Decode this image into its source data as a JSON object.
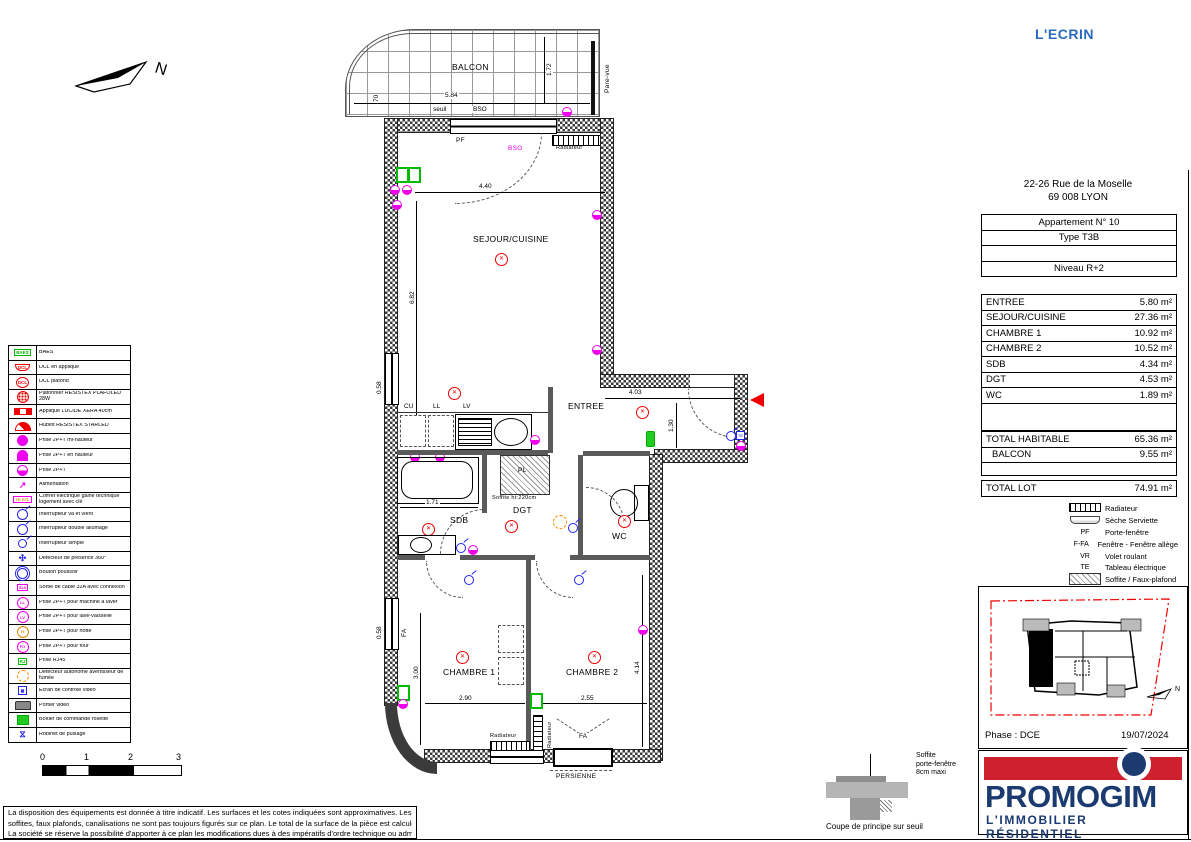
{
  "project": {
    "name": "L'ECRIN",
    "address_line1": "22-26 Rue de la Moselle",
    "address_line2": "69 008  LYON",
    "phase": "Phase : DCE",
    "date": "19/07/2024"
  },
  "apartment": {
    "rows": [
      "Appartement N° 10",
      "Type T3B",
      "",
      "Niveau R+2"
    ]
  },
  "areas": [
    {
      "label": "ENTREE",
      "value": "5.80 m²"
    },
    {
      "label": "SEJOUR/CUISINE",
      "value": "27.36 m²"
    },
    {
      "label": "CHAMBRE 1",
      "value": "10.92 m²"
    },
    {
      "label": "CHAMBRE 2",
      "value": "10.52 m²"
    },
    {
      "label": "SDB",
      "value": "4.34 m²"
    },
    {
      "label": "DGT",
      "value": "4.53 m²"
    },
    {
      "label": "WC",
      "value": "1.89 m²"
    }
  ],
  "totals": [
    {
      "label": "TOTAL HABITABLE",
      "value": "65.36 m²"
    },
    {
      "label": "BALCON",
      "value": "9.55 m²"
    }
  ],
  "total_lot": {
    "label": "TOTAL LOT",
    "value": "74.91 m²"
  },
  "rightLegend": [
    {
      "abbr": "",
      "label": "Radiateur"
    },
    {
      "abbr": "",
      "label": "Sèche Serviette"
    },
    {
      "abbr": "PF",
      "label": "Porte-fenêtre"
    },
    {
      "abbr": "F-FA",
      "label": "Fenêtre - Fenêtre allège"
    },
    {
      "abbr": "VR",
      "label": "Volet roulant"
    },
    {
      "abbr": "TE",
      "label": "Tableau électrique"
    },
    {
      "abbr": "",
      "label": "Soffite / Faux-plafond"
    }
  ],
  "leftLegend": [
    {
      "sym": "BAES",
      "label": "BAES"
    },
    {
      "sym": "DCL",
      "label": "DCL en applique"
    },
    {
      "sym": "DCL",
      "label": "DCL plafond"
    },
    {
      "sym": "",
      "label": "Plafonnier RESISTEX PLAFOLED 28W"
    },
    {
      "sym": "",
      "label": "Applique LUCIDE XERA 40cm"
    },
    {
      "sym": "",
      "label": "Hublot RESISTEX STARLED"
    },
    {
      "sym": "",
      "label": "Prise 2P+T mi-hauteur"
    },
    {
      "sym": "",
      "label": "Prise 2P+T en hauteur"
    },
    {
      "sym": "",
      "label": "Prise 2P+T"
    },
    {
      "sym": "↗",
      "label": "Alimentation"
    },
    {
      "sym": "TE GTL",
      "label": "Coffret électrique gaine technique logement avec clé"
    },
    {
      "sym": "",
      "label": "Interrupteur va et vient"
    },
    {
      "sym": "",
      "label": "Interrupteur double allumage"
    },
    {
      "sym": "",
      "label": "Interrupteur simple"
    },
    {
      "sym": "✣",
      "label": "Détecteur de présence 360°"
    },
    {
      "sym": "",
      "label": "Bouton poussoir"
    },
    {
      "sym": "32A",
      "label": "Sortie de câble 32A avec connexion"
    },
    {
      "sym": "LL",
      "label": "Prise 2P+T pour machine à laver"
    },
    {
      "sym": "LV",
      "label": "Prise 2P+T pour lave-vaisselle"
    },
    {
      "sym": "H",
      "label": "Prise 2P+T pour hotte"
    },
    {
      "sym": "FO",
      "label": "Prise 2P+T pour four"
    },
    {
      "sym": "RJ",
      "label": "Prise RJ45"
    },
    {
      "sym": "",
      "label": "Détecteur autonome avertisseur de fumée"
    },
    {
      "sym": "",
      "label": "Écran de contrôle vidéo"
    },
    {
      "sym": "",
      "label": "Portier vidéo"
    },
    {
      "sym": "",
      "label": "Boîtier de commande rosette"
    },
    {
      "sym": "⧖",
      "label": "Robinet de puisage"
    }
  ],
  "plan": {
    "balcon": "BALCON",
    "sejour": "SEJOUR/CUISINE",
    "entree": "ENTREE",
    "sdb": "SDB",
    "dgt": "DGT",
    "wc": "WC",
    "chambre1": "CHAMBRE 1",
    "chambre2": "CHAMBRE 2",
    "persienne": "PERSIENNE",
    "pf": "PF",
    "fa": "FA",
    "bso": "BSO",
    "seuil": "seuil",
    "pare_vue": "Pare-vue",
    "radiateur": "Radiateur",
    "cu": "CU",
    "ll": "LL",
    "lv": "LV",
    "pl": "PL",
    "soffite_note": "Soffite ht:220cm",
    "north": "N",
    "dims": {
      "balcon_l": "5.84",
      "balcon_d": "1.72",
      "d70": "70",
      "sejour_w": "4.40",
      "sejour_h": "6.82",
      "entree_w": "4.03",
      "entree_h": "1.30",
      "sdb_w": "1.71",
      "ch1_h": "3.00",
      "ch1_w": "2.90",
      "ch2_w": "2.55",
      "ch2_h": "4.14",
      "win": "0.58"
    }
  },
  "scalebar": {
    "t0": "0",
    "t1": "1",
    "t2": "2",
    "t3": "3"
  },
  "coupe": {
    "note1": "Soffite",
    "note2": "porte-fenêtre",
    "note3": "8cm maxi",
    "caption": "Coupe de principe sur seuil"
  },
  "logo": {
    "name": "PROMOGIM",
    "tagline": "L'IMMOBILIER  RÉSIDENTIEL",
    "red": "#cf2030",
    "navy": "#1a3a70"
  },
  "footer": {
    "line1": "La disposition des équipements est donnée à titre indicatif.  Les surfaces et les cotes indiquées sont approximatives.  Les retombées,",
    "line2": "soffites, faux plafonds, canalisations ne sont pas toujours figurés sur ce plan.  Le total de la surface de la pièce est calculé avec le placard.",
    "line3": "La société se réserve la possibilité d'apporter à ce plan les modifications dues à des impératifs d'ordre technique ou administratif."
  }
}
